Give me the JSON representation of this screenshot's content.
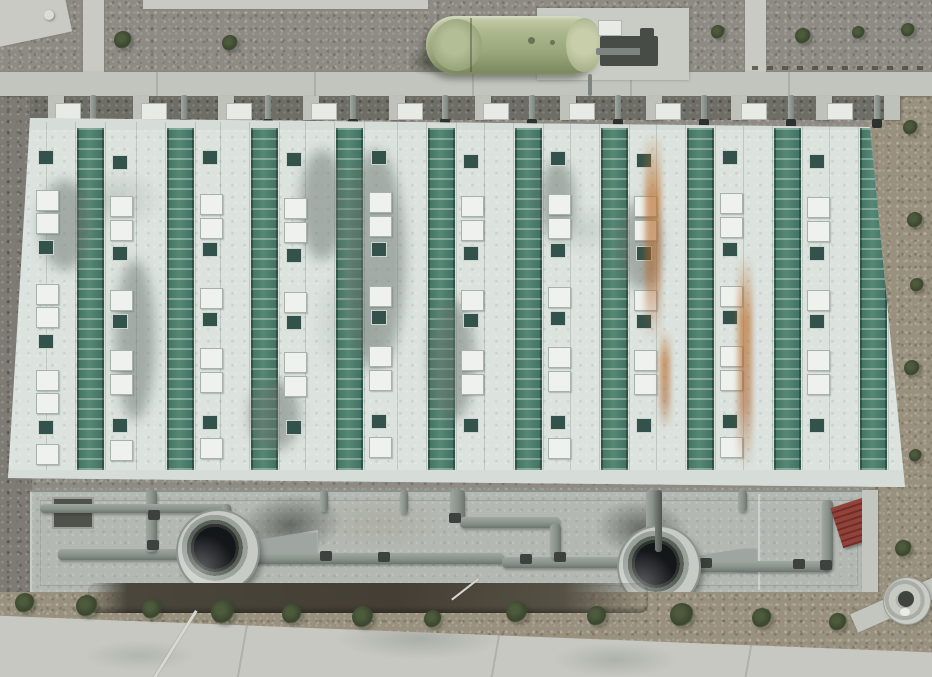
{
  "meta": {
    "type": "aerial-photo",
    "description": "Top-down drone photograph of an industrial treatment facility: large rectangular building with alternating white and green louvered roof stripes, skylights and vents, a green horizontal storage tank on a concrete pad at top, a concrete pipe apron with two large circular fan/tank openings at bottom, gravel terrain with shrubs, and a concrete road along the bottom edge."
  },
  "palette": {
    "gravel_top": "#8e8b84",
    "gravel_dark": "#7d7b73",
    "gravel_brown": "#99917e",
    "path": "#c8cac3",
    "walkway": "#c2c5be",
    "roof_white": "#dce3df",
    "roof_green": "#4b7c6b",
    "skylight": "#eef1ee",
    "vent": "#33524b",
    "eave": "#d6dcd8",
    "apron": "#b3b8b2",
    "pipe": "#8a928c",
    "pipe_joint": "#3d423e",
    "fan_rim": "#c6cbc5",
    "fan_hole": "#14171a",
    "tank_green": "#a3ae84",
    "pad": "#c9ccc5",
    "equipment": "#474d46",
    "bush": "#39462e",
    "trench": "#443e34",
    "pavement": "#c7c8c2",
    "stair_red": "#8f4038",
    "rust": "#ba6c26"
  },
  "terrain": {
    "top_bushes": [
      [
        123,
        40,
        18
      ],
      [
        230,
        43,
        16
      ],
      [
        652,
        34,
        16
      ],
      [
        718,
        32,
        14
      ],
      [
        803,
        36,
        16
      ],
      [
        858,
        32,
        13
      ],
      [
        908,
        30,
        14
      ]
    ],
    "right_bushes": [
      [
        910,
        127,
        15
      ],
      [
        915,
        220,
        16
      ],
      [
        917,
        285,
        14
      ],
      [
        912,
        368,
        16
      ],
      [
        915,
        455,
        13
      ],
      [
        903,
        548,
        17
      ]
    ],
    "bottom_bushes": [
      [
        25,
        603,
        20
      ],
      [
        87,
        606,
        22
      ],
      [
        152,
        609,
        20
      ],
      [
        223,
        612,
        24
      ],
      [
        292,
        614,
        20
      ],
      [
        363,
        617,
        22
      ],
      [
        433,
        619,
        18
      ],
      [
        517,
        612,
        22
      ],
      [
        597,
        616,
        20
      ],
      [
        682,
        615,
        24
      ],
      [
        762,
        618,
        20
      ],
      [
        838,
        622,
        18
      ]
    ],
    "stone": [
      44,
      10,
      10
    ],
    "paths": {
      "corner_pad": [
        -10,
        -8,
        78,
        48,
        -12
      ],
      "top_strip": [
        143,
        0,
        285,
        9
      ],
      "vertical_left": [
        83,
        0,
        21,
        76
      ],
      "vertical_right": [
        745,
        0,
        21,
        76
      ],
      "walkway": [
        0,
        72,
        932,
        24
      ],
      "fence": [
        752,
        66,
        180,
        4
      ]
    }
  },
  "colonnade": {
    "band": [
      30,
      96,
      860,
      24
    ],
    "pillars": [
      48,
      133,
      218,
      303,
      389,
      475,
      560,
      646,
      731,
      816,
      884
    ],
    "pipes": [
      90,
      181,
      265,
      350,
      442,
      529,
      615,
      701,
      788,
      874
    ],
    "panels": [
      55,
      141,
      226,
      311,
      397,
      483,
      569,
      655,
      741,
      827
    ]
  },
  "tank": {
    "pad": [
      537,
      8,
      152,
      72
    ],
    "body": [
      426,
      16,
      176,
      58
    ],
    "cap_left": [
      432,
      19,
      50,
      52
    ],
    "cap_right": [
      566,
      18,
      36,
      54
    ],
    "equipment_box": [
      598,
      20,
      22,
      14
    ],
    "equipment_frame": [
      600,
      36,
      58,
      30
    ],
    "equipment_small": [
      640,
      28,
      14,
      36
    ],
    "drop_pipe": [
      588,
      74,
      4,
      22
    ]
  },
  "building": {
    "box": [
      8,
      118,
      897,
      372
    ],
    "clip": "polygon(22px 0px, 862px 9px, 897px 369px, 0px 360px)",
    "stripes": [
      69,
      159,
      243,
      328,
      420,
      507,
      593,
      679,
      766,
      852
    ],
    "stripe_width": 27,
    "stripe_top": 10,
    "stripe_height": 346,
    "eave_top": [
      0,
      0,
      897,
      12
    ],
    "eave_bottom": [
      0,
      352,
      897,
      20
    ],
    "features": [
      [
        36,
        150,
        "v"
      ],
      [
        36,
        190,
        "s"
      ],
      [
        36,
        213,
        "s"
      ],
      [
        36,
        240,
        "v"
      ],
      [
        36,
        284,
        "s"
      ],
      [
        36,
        307,
        "s"
      ],
      [
        36,
        334,
        "v"
      ],
      [
        36,
        370,
        "s"
      ],
      [
        36,
        393,
        "s"
      ],
      [
        36,
        420,
        "v"
      ],
      [
        36,
        444,
        "s"
      ],
      [
        110,
        155,
        "v"
      ],
      [
        110,
        196,
        "s"
      ],
      [
        110,
        220,
        "s"
      ],
      [
        110,
        246,
        "v"
      ],
      [
        110,
        290,
        "s"
      ],
      [
        110,
        314,
        "v"
      ],
      [
        110,
        350,
        "s"
      ],
      [
        110,
        374,
        "s"
      ],
      [
        110,
        418,
        "v"
      ],
      [
        110,
        440,
        "s"
      ],
      [
        200,
        150,
        "v"
      ],
      [
        200,
        194,
        "s"
      ],
      [
        200,
        218,
        "s"
      ],
      [
        200,
        242,
        "v"
      ],
      [
        200,
        288,
        "s"
      ],
      [
        200,
        312,
        "v"
      ],
      [
        200,
        348,
        "s"
      ],
      [
        200,
        372,
        "s"
      ],
      [
        200,
        415,
        "v"
      ],
      [
        200,
        438,
        "s"
      ],
      [
        284,
        152,
        "v"
      ],
      [
        284,
        198,
        "s"
      ],
      [
        284,
        222,
        "s"
      ],
      [
        284,
        248,
        "v"
      ],
      [
        284,
        292,
        "s"
      ],
      [
        284,
        315,
        "v"
      ],
      [
        284,
        352,
        "s"
      ],
      [
        284,
        376,
        "s"
      ],
      [
        284,
        420,
        "v"
      ],
      [
        369,
        150,
        "v"
      ],
      [
        369,
        192,
        "s"
      ],
      [
        369,
        216,
        "s"
      ],
      [
        369,
        242,
        "v"
      ],
      [
        369,
        286,
        "s"
      ],
      [
        369,
        310,
        "v"
      ],
      [
        369,
        346,
        "s"
      ],
      [
        369,
        370,
        "s"
      ],
      [
        369,
        414,
        "v"
      ],
      [
        369,
        437,
        "s"
      ],
      [
        461,
        154,
        "v"
      ],
      [
        461,
        196,
        "s"
      ],
      [
        461,
        220,
        "s"
      ],
      [
        461,
        246,
        "v"
      ],
      [
        461,
        290,
        "s"
      ],
      [
        461,
        313,
        "v"
      ],
      [
        461,
        350,
        "s"
      ],
      [
        461,
        374,
        "s"
      ],
      [
        461,
        418,
        "v"
      ],
      [
        548,
        151,
        "v"
      ],
      [
        548,
        194,
        "s"
      ],
      [
        548,
        218,
        "s"
      ],
      [
        548,
        243,
        "v"
      ],
      [
        548,
        287,
        "s"
      ],
      [
        548,
        311,
        "v"
      ],
      [
        548,
        347,
        "s"
      ],
      [
        548,
        371,
        "s"
      ],
      [
        548,
        415,
        "v"
      ],
      [
        548,
        438,
        "s"
      ],
      [
        634,
        153,
        "v"
      ],
      [
        634,
        196,
        "s"
      ],
      [
        634,
        220,
        "s"
      ],
      [
        634,
        246,
        "v"
      ],
      [
        634,
        290,
        "s"
      ],
      [
        634,
        314,
        "v"
      ],
      [
        634,
        350,
        "s"
      ],
      [
        634,
        374,
        "s"
      ],
      [
        634,
        418,
        "v"
      ],
      [
        720,
        150,
        "v"
      ],
      [
        720,
        193,
        "s"
      ],
      [
        720,
        217,
        "s"
      ],
      [
        720,
        242,
        "v"
      ],
      [
        720,
        286,
        "s"
      ],
      [
        720,
        310,
        "v"
      ],
      [
        720,
        346,
        "s"
      ],
      [
        720,
        370,
        "s"
      ],
      [
        720,
        414,
        "v"
      ],
      [
        720,
        437,
        "s"
      ],
      [
        807,
        154,
        "v"
      ],
      [
        807,
        197,
        "s"
      ],
      [
        807,
        221,
        "s"
      ],
      [
        807,
        246,
        "v"
      ],
      [
        807,
        290,
        "s"
      ],
      [
        807,
        314,
        "v"
      ],
      [
        807,
        350,
        "s"
      ],
      [
        807,
        374,
        "s"
      ],
      [
        807,
        418,
        "v"
      ]
    ],
    "stains": [
      [
        40,
        180,
        50,
        90
      ],
      [
        115,
        260,
        40,
        160
      ],
      [
        345,
        150,
        60,
        220
      ],
      [
        430,
        300,
        45,
        120
      ],
      [
        620,
        200,
        40,
        90
      ],
      [
        250,
        380,
        50,
        70
      ],
      [
        540,
        160,
        35,
        80
      ],
      [
        300,
        150,
        45,
        110
      ]
    ],
    "rust": [
      [
        645,
        132,
        16,
        210
      ],
      [
        738,
        255,
        14,
        215
      ],
      [
        660,
        330,
        10,
        100
      ]
    ]
  },
  "apron": {
    "box": [
      30,
      490,
      836,
      102
    ],
    "notch": [
      52,
      497,
      38,
      28
    ],
    "seam": [
      758,
      494,
      2,
      96
    ],
    "stair": [
      836,
      502,
      34,
      42
    ],
    "wall_strip": [
      862,
      490,
      16,
      124
    ],
    "pipes": [
      [
        58,
        549,
        160,
        11,
        "h"
      ],
      [
        252,
        553,
        252,
        11,
        "h"
      ],
      [
        502,
        557,
        152,
        11,
        "h"
      ],
      [
        695,
        561,
        135,
        11,
        "h"
      ],
      [
        822,
        500,
        11,
        70,
        "v"
      ],
      [
        146,
        490,
        11,
        62,
        "v"
      ],
      [
        40,
        504,
        190,
        9,
        "h"
      ],
      [
        222,
        504,
        9,
        48,
        "v"
      ],
      [
        450,
        490,
        15,
        30,
        "v"
      ],
      [
        460,
        517,
        100,
        11,
        "h"
      ],
      [
        550,
        524,
        11,
        34,
        "v"
      ],
      [
        646,
        490,
        11,
        42,
        "v"
      ],
      [
        320,
        490,
        8,
        22,
        "v"
      ],
      [
        400,
        490,
        8,
        24,
        "v"
      ],
      [
        738,
        490,
        9,
        22,
        "v"
      ]
    ],
    "joints": [
      [
        147,
        540
      ],
      [
        224,
        546
      ],
      [
        320,
        551
      ],
      [
        449,
        513
      ],
      [
        554,
        552
      ],
      [
        649,
        526
      ],
      [
        700,
        558
      ],
      [
        793,
        559
      ],
      [
        820,
        560
      ],
      [
        378,
        552
      ],
      [
        520,
        554
      ],
      [
        148,
        510
      ]
    ]
  },
  "fans": {
    "left": {
      "cx": 218,
      "cy": 551,
      "r": 40
    },
    "right": {
      "cx": 659,
      "cy": 567,
      "r": 40
    },
    "shadow_pads": [
      [
        238,
        494,
        104,
        62,
        -8
      ],
      [
        596,
        500,
        92,
        58,
        6
      ]
    ],
    "funnels": [
      [
        244,
        530,
        74,
        32,
        "right"
      ],
      [
        692,
        546,
        66,
        28,
        "right"
      ]
    ],
    "over_pipe": [
      655,
      490,
      7,
      62
    ]
  },
  "bottom": {
    "gravel": [
      0,
      592,
      932,
      85
    ],
    "trench": [
      88,
      583,
      560,
      30
    ],
    "pavement": [
      0,
      592,
      932,
      85
    ],
    "poles": [
      [
        195,
        610,
        3,
        82,
        32
      ],
      [
        478,
        578,
        2,
        34,
        52
      ]
    ],
    "manhole": [
      884,
      578,
      46
    ],
    "corner_path": [
      850,
      594,
      96,
      20,
      -24
    ]
  }
}
